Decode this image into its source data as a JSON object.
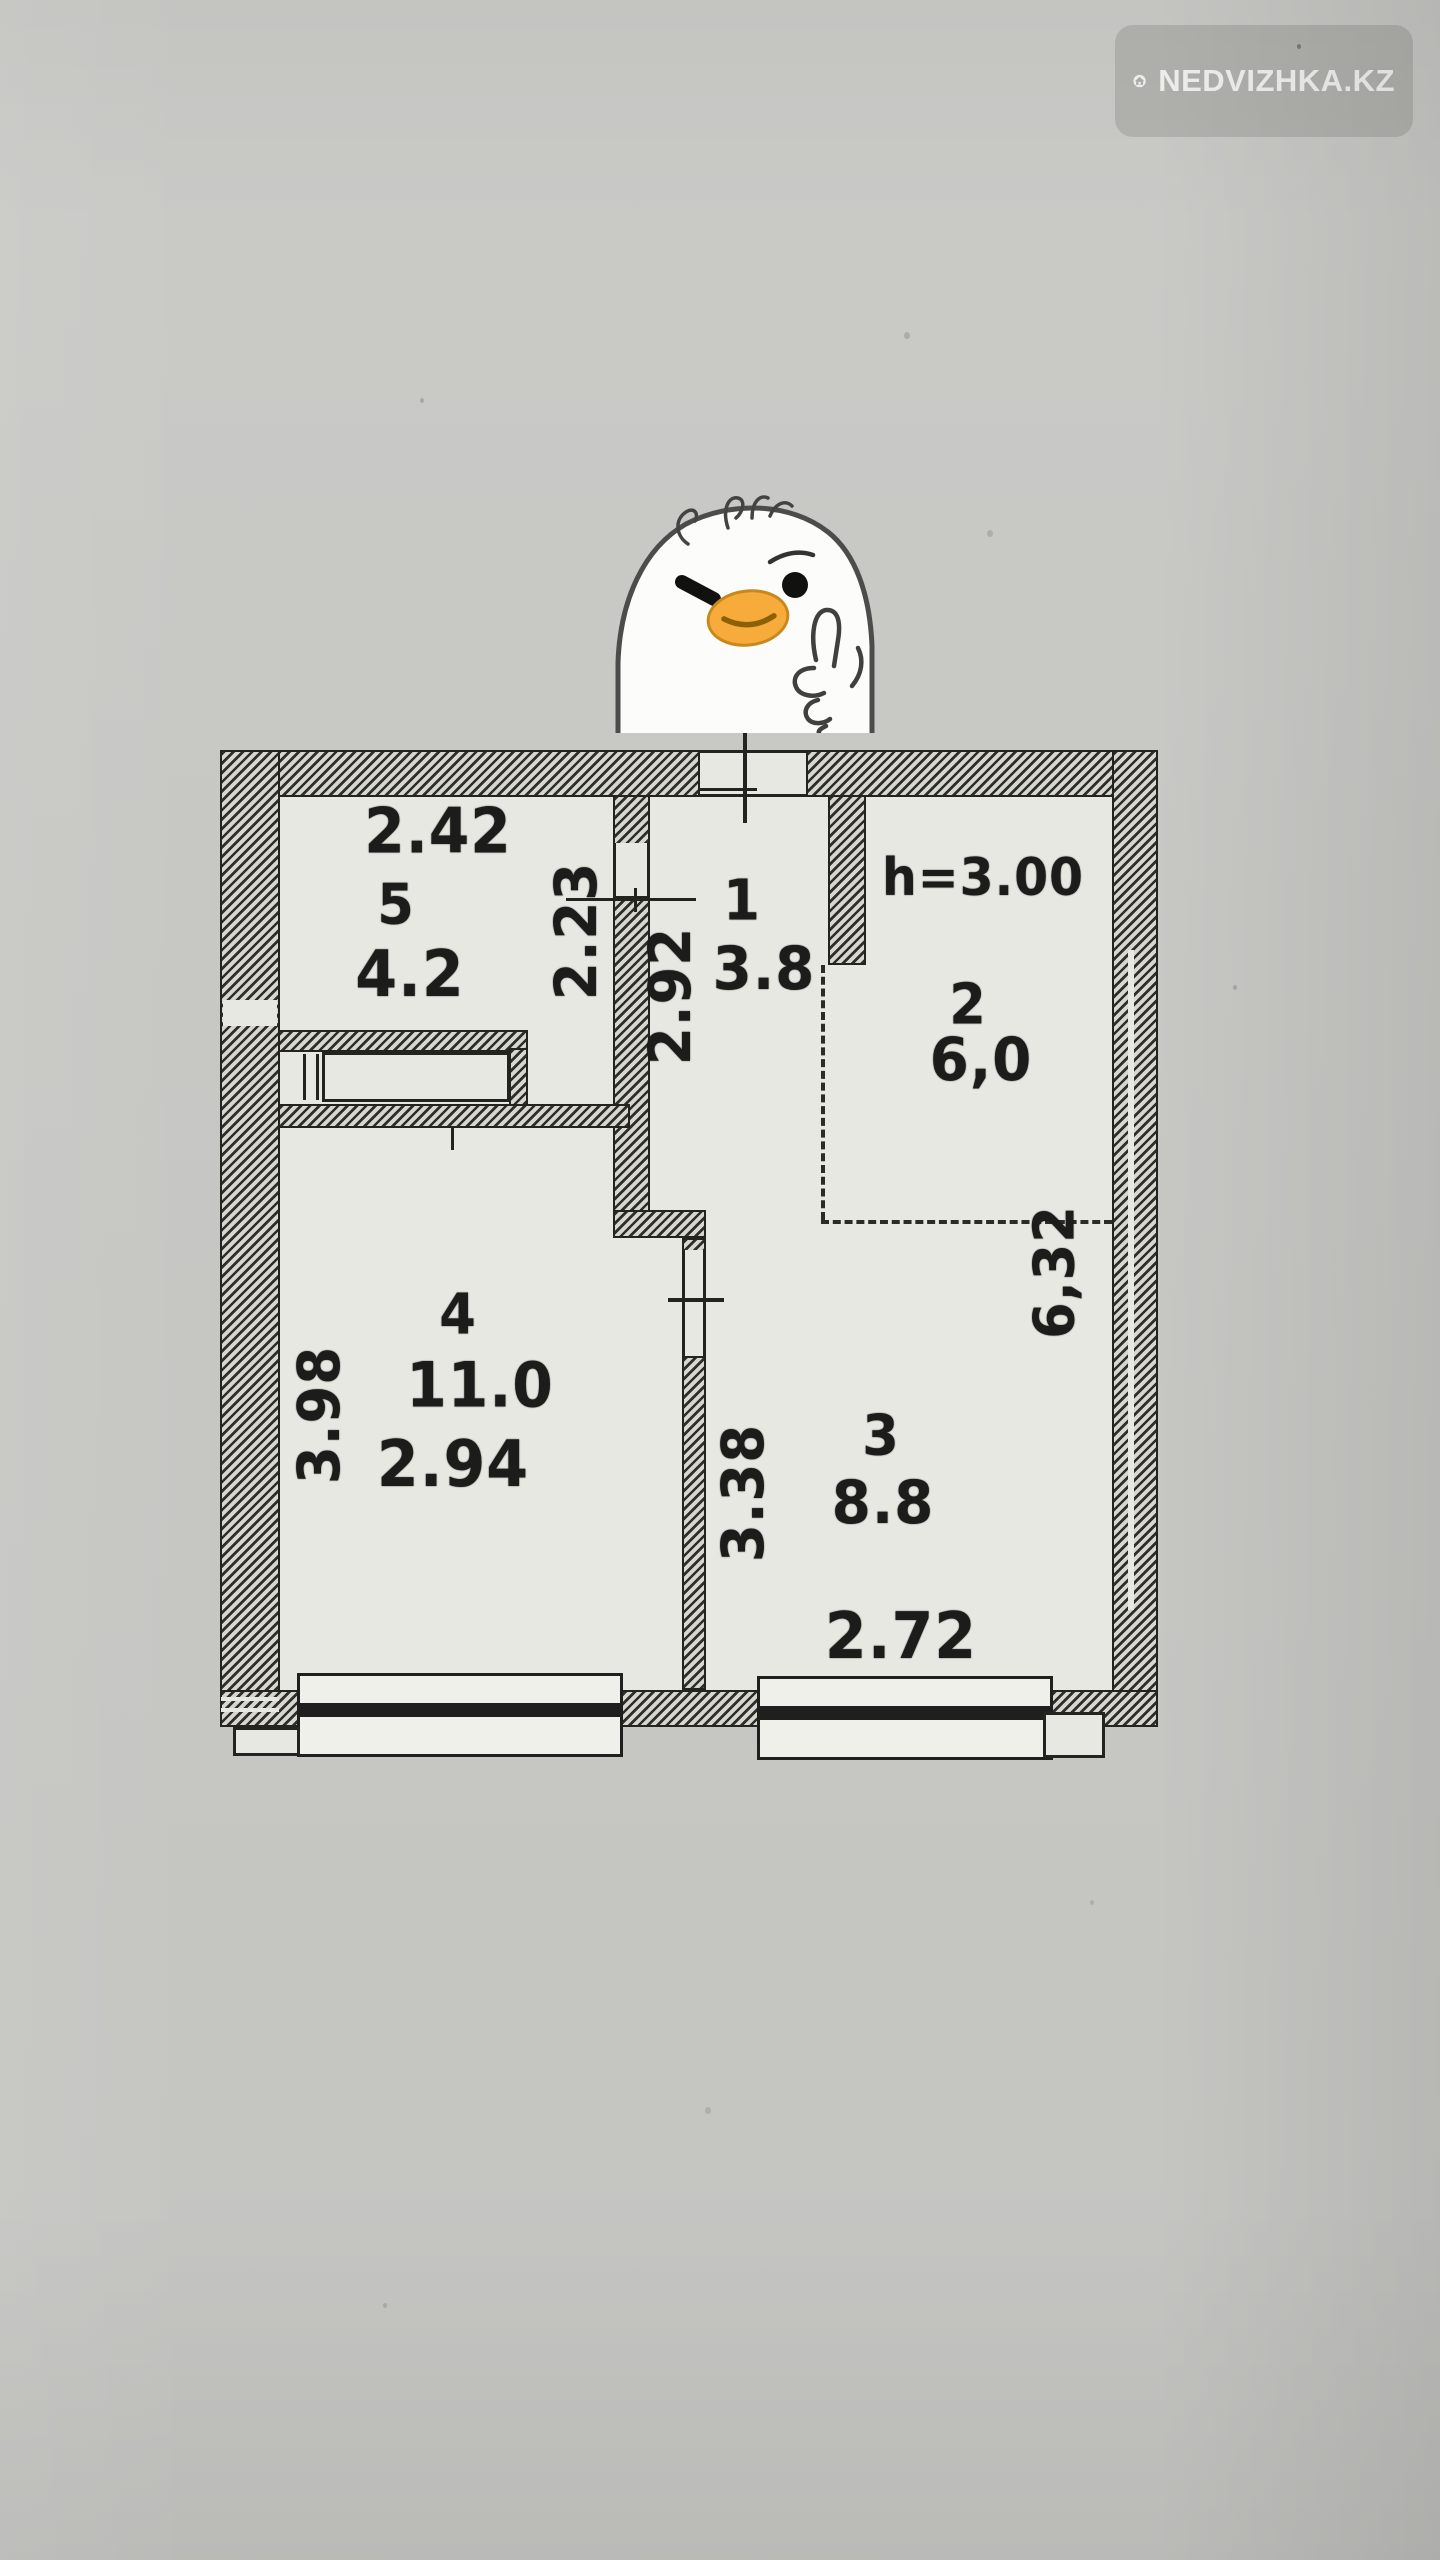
{
  "colors": {
    "paper": "#c7c7c4",
    "plan_paper": "#e8e8e2",
    "ink": "#222220",
    "wall_hatch": "#2e2e2b",
    "beak_orange": "#f6ab3a",
    "watermark_bg": "#aeaeab",
    "watermark_fg": "#f2f2f0"
  },
  "watermark": {
    "label": "NEDVIZHKA.KZ",
    "icon": "house-icon"
  },
  "sticker": {
    "icon": "duck-thumbs-up-sticker"
  },
  "plan": {
    "ceiling_height": "h=3.00",
    "rooms": [
      {
        "id": "1",
        "area": "3.8"
      },
      {
        "id": "2",
        "area": "6,0"
      },
      {
        "id": "3",
        "area": "8.8"
      },
      {
        "id": "4",
        "area": "11.0"
      },
      {
        "id": "5",
        "area": "4.2"
      }
    ],
    "dims": {
      "room5_width": "2.42",
      "room5_depth": "2.23",
      "hall_depth": "2.92",
      "east_side": "6,32",
      "room4_depth": "3.98",
      "room4_width": "2.94",
      "room3_depth": "3.38",
      "room3_width": "2.72"
    }
  }
}
